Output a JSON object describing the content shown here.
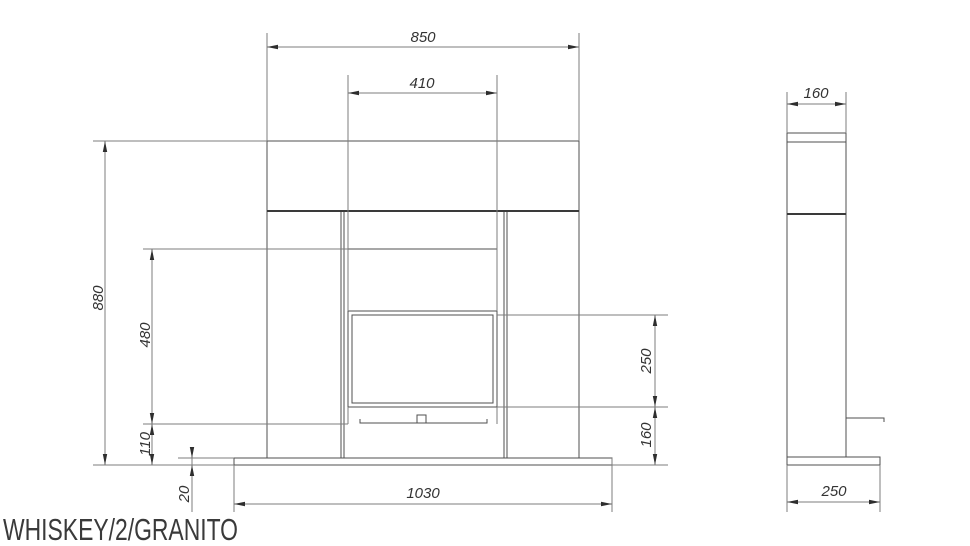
{
  "title": "WHISKEY/2/GRANITO",
  "dimensions": {
    "front": {
      "shelf_width": "850",
      "opening_width": "410",
      "total_height": "880",
      "opening_height": "480",
      "hearth_height": "110",
      "plinth_thickness": "20",
      "base_width": "1030",
      "glass_height": "250",
      "lower_height": "160"
    },
    "side": {
      "depth": "160",
      "base_depth": "250"
    }
  },
  "colors": {
    "background": "#ffffff",
    "outline": "#4f4f4f",
    "dimension_lines": "#7c7c7c",
    "arrowheads": "#2e2e2e",
    "dimension_text": "#333333",
    "title_text": "#3a3a3a"
  }
}
